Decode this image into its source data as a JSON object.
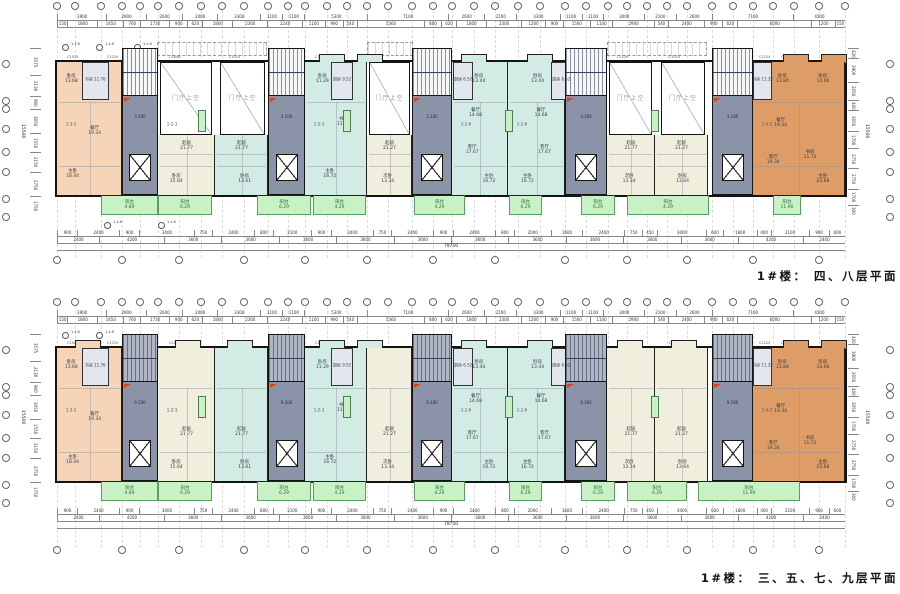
{
  "titles": {
    "plan1": "1#楼： 四、八层平面",
    "plan2": "1#楼： 三、五、七、九层平面"
  },
  "void_label": "门厅上空",
  "marker_label": "1.4.6",
  "colors": {
    "wall": "#141414",
    "peach": "#f5d4b8",
    "orange": "#de9c66",
    "cream": "#f0eedd",
    "cyan": "#d3ebe5",
    "grayblue": "#e2e7ee",
    "core": "#8b93a8",
    "stair_light": "#f7f8fa",
    "stair_dark": "#b0b6c4",
    "green": "#c8f2c6",
    "red": "#e2400e",
    "white": "#ffffff"
  },
  "dims": {
    "top_row1": [
      "3900",
      "2900",
      "2600",
      "2400",
      "3300",
      "1100",
      "1100",
      "5300",
      "7100",
      "2600",
      "2100",
      "3300",
      "1100",
      "1100",
      "3000",
      "2100",
      "2600",
      "7100",
      "4200"
    ],
    "top_row2": [
      "150",
      "1800",
      "1450",
      "760",
      "1730",
      "900",
      "620",
      "1800",
      "2300",
      "2240",
      "1100",
      "900",
      "540",
      "5360",
      "800",
      "620",
      "1800",
      "2300",
      "1200",
      "900",
      "1500",
      "1100",
      "2900",
      "540",
      "2400",
      "900",
      "620",
      "6000",
      "1200",
      "150"
    ],
    "bot_row1": [
      "900",
      "2400",
      "900",
      "3400",
      "750",
      "2400",
      "800",
      "2100",
      "900",
      "2400",
      "750",
      "2400",
      "900",
      "2400",
      "800",
      "2000",
      "1600",
      "2400",
      "750",
      "450",
      "3000",
      "600",
      "1800",
      "400",
      "2100",
      "900",
      "600"
    ],
    "bot_row2": [
      "2400",
      "4200",
      "3600",
      "3600",
      "3600",
      "3600",
      "3600",
      "3600",
      "3600",
      "3600",
      "3600",
      "3600",
      "4200",
      "2400"
    ],
    "total_length": "79750",
    "left_col": [
      "3575",
      "2130",
      "900",
      "3050",
      "1550",
      "2150",
      "2750",
      "1750"
    ],
    "right_col": [
      "420",
      "3900",
      "2050",
      "400",
      "3050",
      "1700",
      "2750",
      "2750",
      "1700",
      "300"
    ],
    "side_total": "15500"
  },
  "window_tags": [
    {
      "x": 10,
      "t": "C1525"
    },
    {
      "x": 50,
      "t": "C1229"
    },
    {
      "x": 112,
      "t": "C1806"
    },
    {
      "x": 172,
      "t": "C1525"
    },
    {
      "x": 258,
      "t": "C1229"
    },
    {
      "x": 300,
      "t": "C1525"
    },
    {
      "x": 362,
      "t": "C1229"
    },
    {
      "x": 404,
      "t": "C1525"
    },
    {
      "x": 470,
      "t": "C1806"
    },
    {
      "x": 560,
      "t": "C1229"
    },
    {
      "x": 612,
      "t": "C1525"
    },
    {
      "x": 702,
      "t": "C1224"
    },
    {
      "x": 724,
      "t": "C1525"
    },
    {
      "x": 770,
      "t": "C1806"
    }
  ],
  "geometry": {
    "building_x": 57,
    "building_w": 788,
    "main_h": 133,
    "balcony_h": 20,
    "grid_x": [
      0,
      18,
      44,
      65,
      83,
      101,
      122,
      144,
      165,
      187,
      211,
      231,
      248,
      270,
      290,
      310,
      331,
      355,
      376,
      395,
      417,
      438,
      461,
      483,
      508,
      529,
      551,
      570,
      590,
      610,
      630,
      655,
      676,
      696,
      716,
      737,
      762,
      788
    ],
    "side_ys": [
      -2,
      35,
      43,
      63,
      86,
      106,
      133,
      151
    ],
    "cores": [
      {
        "x": 65,
        "w": 36
      },
      {
        "x": 211,
        "w": 37
      },
      {
        "x": 355,
        "w": 40
      },
      {
        "x": 508,
        "w": 42
      },
      {
        "x": 655,
        "w": 41
      }
    ],
    "core_elev_label_1": "3.100",
    "core_elev_label_2": "9.100",
    "voids": [
      {
        "x": 103,
        "w": 52
      },
      {
        "x": 163,
        "w": 45
      },
      {
        "x": 312,
        "w": 41
      },
      {
        "x": 552,
        "w": 43
      },
      {
        "x": 604,
        "w": 44
      }
    ],
    "canopies": [
      {
        "x": 100,
        "w": 110
      },
      {
        "x": 310,
        "w": 46
      },
      {
        "x": 550,
        "w": 100
      }
    ],
    "shafts": [
      141,
      286,
      448,
      594
    ],
    "units": [
      {
        "x": 0,
        "w": 65,
        "color": "peach",
        "voidAbove": false,
        "unum": "1-3-2",
        "top_room": {
          "n": "书房",
          "a": "11.76",
          "x": 38,
          "w": 27
        },
        "rooms": [
          {
            "n": "卧房",
            "a": "13.68",
            "l": 22,
            "t": 13
          },
          {
            "n": "餐厅",
            "a": "19.34",
            "l": 58,
            "t": 52
          },
          {
            "n": "主卧",
            "a": "18.44",
            "l": 24,
            "t": 84
          }
        ]
      },
      {
        "x": 101,
        "w": 57,
        "color": "cream",
        "voidAbove": true,
        "unum": "1-2-3",
        "rooms": [
          {
            "n": "起居",
            "a": "21.77",
            "l": 50,
            "t": 63
          },
          {
            "n": "卧房",
            "a": "15.64",
            "l": 32,
            "t": 88
          }
        ]
      },
      {
        "x": 158,
        "w": 53,
        "color": "cyan",
        "voidAbove": true,
        "rooms": [
          {
            "n": "起居",
            "a": "21.77",
            "l": 50,
            "t": 63
          },
          {
            "n": "卧房",
            "a": "13.61",
            "l": 56,
            "t": 88
          }
        ]
      },
      {
        "x": 248,
        "w": 62,
        "color": "cyan",
        "voidAbove": false,
        "unum": "1-2-3",
        "top_room": {
          "n": "厨房",
          "a": "9.52",
          "x": 42,
          "w": 22
        },
        "rooms": [
          {
            "n": "卧房",
            "a": "11.29",
            "l": 28,
            "t": 13
          },
          {
            "n": "书房",
            "a": "11.23",
            "l": 62,
            "t": 45
          },
          {
            "n": "主卧",
            "a": "16.72",
            "l": 40,
            "t": 84
          }
        ]
      },
      {
        "x": 310,
        "w": 45,
        "color": "cream",
        "voidAbove": true,
        "rooms": [
          {
            "n": "起居",
            "a": "21.27",
            "l": 50,
            "t": 63
          },
          {
            "n": "次卧",
            "a": "13.34",
            "l": 46,
            "t": 88
          }
        ]
      },
      {
        "x": 395,
        "w": 56,
        "color": "cyan",
        "voidAbove": false,
        "unum": "1-2-6",
        "top_room": {
          "n": "厨房",
          "a": "6.52",
          "x": 2,
          "w": 20
        },
        "rooms": [
          {
            "n": "卧房",
            "a": "13.44",
            "l": 48,
            "t": 13
          },
          {
            "n": "餐厅",
            "a": "14.68",
            "l": 42,
            "t": 38
          },
          {
            "n": "客厅",
            "a": "17.67",
            "l": 36,
            "t": 66
          },
          {
            "n": "主卧",
            "a": "16.72",
            "l": 66,
            "t": 88
          }
        ]
      },
      {
        "x": 451,
        "w": 57,
        "color": "cyan",
        "voidAbove": false,
        "unum": "1-2-6",
        "top_room": {
          "n": "厨房",
          "a": "6.52",
          "x": 76,
          "w": 20
        },
        "rooms": [
          {
            "n": "卧房",
            "a": "13.44",
            "l": 52,
            "t": 13
          },
          {
            "n": "餐厅",
            "a": "14.68",
            "l": 58,
            "t": 38
          },
          {
            "n": "客厅",
            "a": "17.67",
            "l": 64,
            "t": 66
          },
          {
            "n": "主卧",
            "a": "16.72",
            "l": 34,
            "t": 88
          }
        ]
      },
      {
        "x": 550,
        "w": 48,
        "color": "cream",
        "voidAbove": true,
        "rooms": [
          {
            "n": "起居",
            "a": "21.77",
            "l": 50,
            "t": 63
          },
          {
            "n": "次卧",
            "a": "13.34",
            "l": 46,
            "t": 88
          }
        ]
      },
      {
        "x": 598,
        "w": 53,
        "color": "cream",
        "voidAbove": true,
        "rooms": [
          {
            "n": "起居",
            "a": "21.27",
            "l": 50,
            "t": 63
          },
          {
            "n": "卧房",
            "a": "13.64",
            "l": 52,
            "t": 88
          }
        ]
      },
      {
        "x": 696,
        "w": 92,
        "color": "orange",
        "voidAbove": false,
        "unum": "1-4-2",
        "top_room": {
          "n": "书房",
          "a": "11.32",
          "x": 0,
          "w": 19
        },
        "rooms": [
          {
            "n": "卧房",
            "a": "13.84",
            "l": 32,
            "t": 13
          },
          {
            "n": "卧房",
            "a": "14.06",
            "l": 76,
            "t": 13
          },
          {
            "n": "餐厅",
            "a": "19.34",
            "l": 30,
            "t": 46
          },
          {
            "n": "书房",
            "a": "11.72",
            "l": 62,
            "t": 70
          },
          {
            "n": "客厅",
            "a": "19.34",
            "l": 22,
            "t": 74
          },
          {
            "n": "主卧",
            "a": "23.68",
            "l": 76,
            "t": 88
          }
        ]
      }
    ],
    "balcony_label": "阳台",
    "plans": [
      {
        "key": "plan1",
        "name": "floors-4-8",
        "by": 62,
        "bub_top": 2,
        "rows_top": [
          14,
          21
        ],
        "rows_bot": [
          230,
          237
        ],
        "tot_y": 244,
        "bub_bot": 256,
        "title_y": 268,
        "has_voids": true,
        "stair": "stair_light",
        "core_label": "3.100",
        "markers_top": [
          62,
          96,
          134
        ],
        "markers_bot": [
          104,
          158
        ],
        "marker_top_y": 44,
        "marker_bot_y": 222,
        "bays": [
          262,
          300,
          404,
          470,
          726,
          764
        ],
        "balconies": [
          {
            "x": 44,
            "w": 57,
            "a": "4.89"
          },
          {
            "x": 101,
            "w": 54,
            "a": "6.29"
          },
          {
            "x": 200,
            "w": 54,
            "a": "6.29"
          },
          {
            "x": 256,
            "w": 53,
            "a": "4.29"
          },
          {
            "x": 357,
            "w": 51,
            "a": "4.29"
          },
          {
            "x": 452,
            "w": 33,
            "a": "6.29"
          },
          {
            "x": 524,
            "w": 34,
            "a": "6.29"
          },
          {
            "x": 570,
            "w": 82,
            "a": "4.29"
          },
          {
            "x": 716,
            "w": 28,
            "a": "11.90"
          }
        ]
      },
      {
        "key": "plan2",
        "name": "floors-3-5-7-9",
        "by": 348,
        "bub_top": 298,
        "rows_top": [
          310,
          317
        ],
        "rows_bot": [
          508,
          515
        ],
        "tot_y": 522,
        "bub_bot": 546,
        "title_y": 570,
        "has_voids": false,
        "stair": "stair_dark",
        "core_label": "9.100",
        "markers_top": [
          62,
          96
        ],
        "markers_bot": [],
        "marker_top_y": 332,
        "marker_bot_y": 0,
        "bays": [
          18,
          118,
          170,
          262,
          300,
          404,
          470,
          560,
          614,
          726,
          764
        ],
        "balconies": [
          {
            "x": 44,
            "w": 57,
            "a": "4.89"
          },
          {
            "x": 101,
            "w": 54,
            "a": "6.29"
          },
          {
            "x": 200,
            "w": 54,
            "a": "6.29"
          },
          {
            "x": 256,
            "w": 53,
            "a": "4.29"
          },
          {
            "x": 357,
            "w": 51,
            "a": "4.29"
          },
          {
            "x": 452,
            "w": 33,
            "a": "6.29"
          },
          {
            "x": 524,
            "w": 34,
            "a": "6.29"
          },
          {
            "x": 570,
            "w": 60,
            "a": "4.29"
          },
          {
            "x": 641,
            "w": 102,
            "a": "11.90"
          }
        ]
      }
    ]
  }
}
